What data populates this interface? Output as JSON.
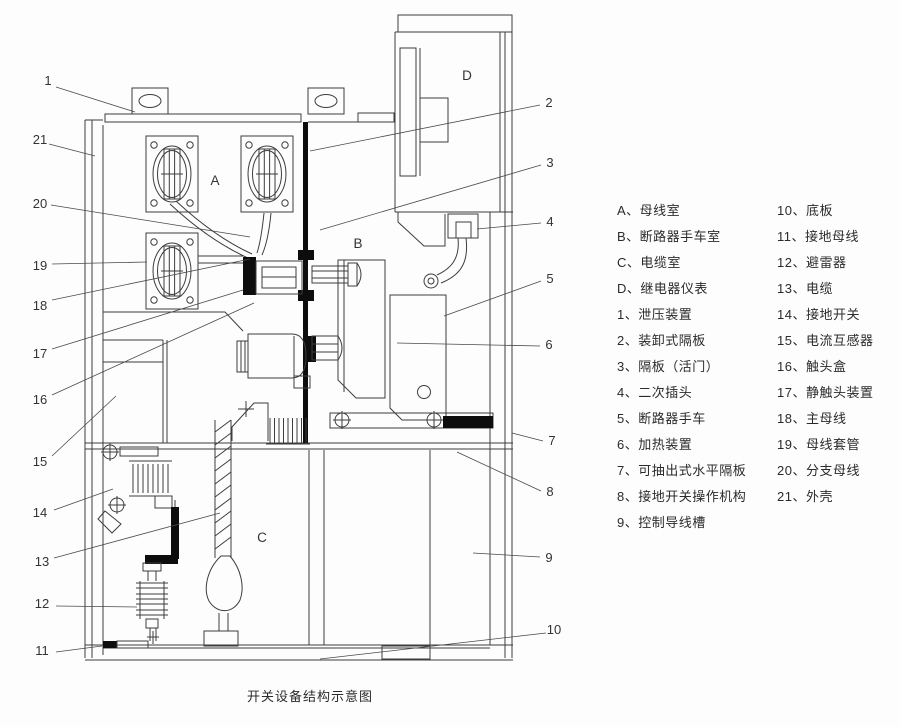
{
  "caption": "开关设备结构示意图",
  "colors": {
    "line": "#3d3d3d",
    "black_fill": "#0d0d0d",
    "background": "#fdfdfd"
  },
  "sections": {
    "a": "A",
    "b": "B",
    "c": "C",
    "d": "D"
  },
  "callouts_left": [
    "1",
    "21",
    "20",
    "19",
    "18",
    "17",
    "16",
    "15",
    "14",
    "13",
    "12",
    "11"
  ],
  "callouts_right": [
    "2",
    "3",
    "4",
    "5",
    "6",
    "7",
    "8",
    "9",
    "10"
  ],
  "legend": {
    "left": [
      "A、母线室",
      "B、断路器手车室",
      "C、电缆室",
      "D、继电器仪表",
      "1、泄压装置",
      "2、装卸式隔板",
      "3、隔板（活门）",
      "4、二次插头",
      "5、断路器手车",
      "6、加热装置",
      "7、可抽出式水平隔板",
      "8、接地开关操作机构",
      "9、控制导线槽"
    ],
    "right": [
      "10、底板",
      "11、接地母线",
      "12、避雷器",
      "13、电缆",
      "14、接地开关",
      "15、电流互感器",
      "16、触头盒",
      "17、静触头装置",
      "18、主母线",
      "19、母线套管",
      "20、分支母线",
      "21、外壳"
    ]
  }
}
